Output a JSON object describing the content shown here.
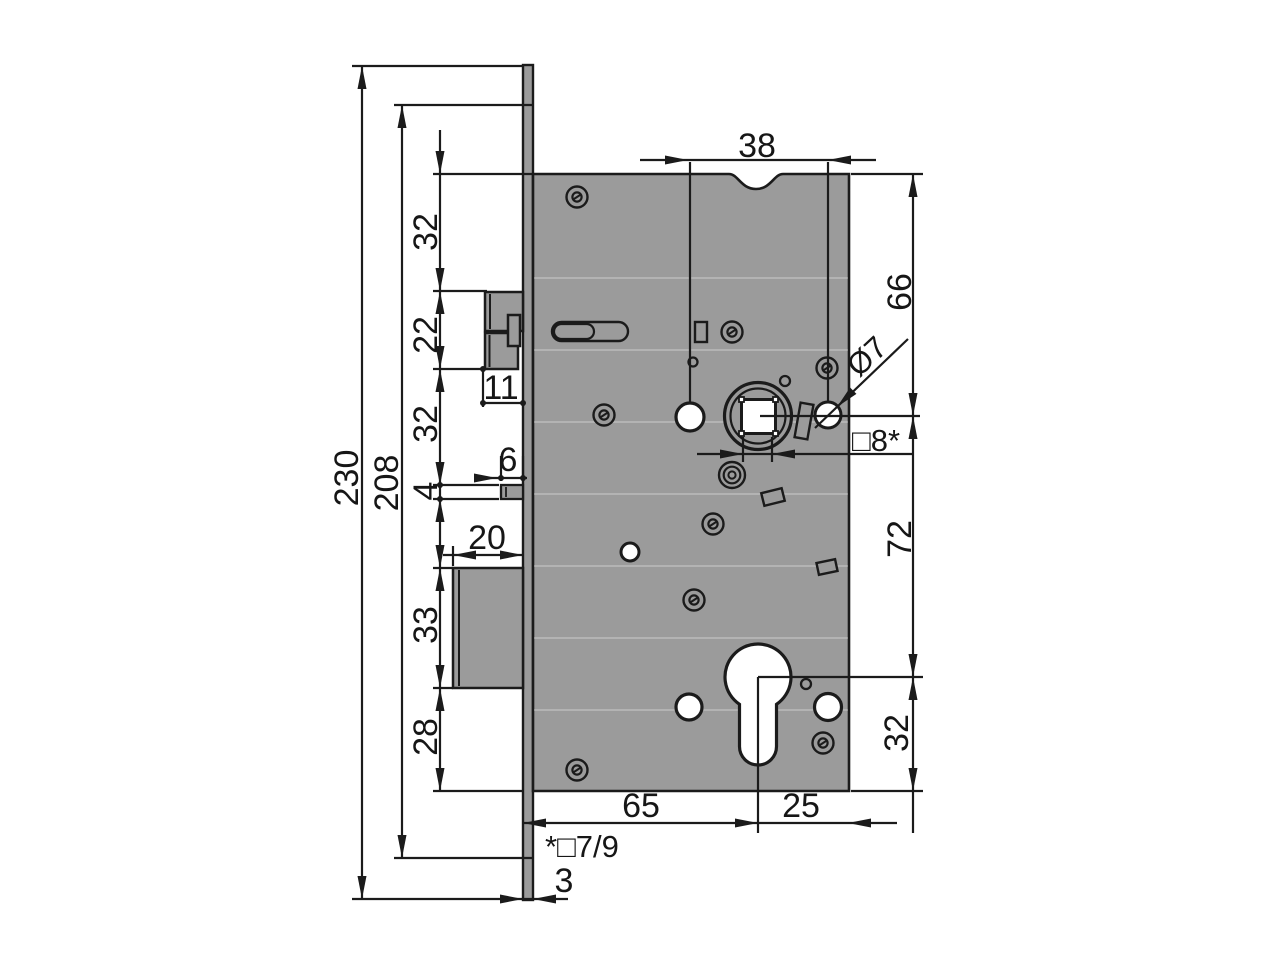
{
  "drawing": {
    "kind": "mortise-lock dimensional drawing",
    "colors": {
      "metal": "#9b9b9b",
      "line": "#1b1b1b",
      "background": "#ffffff"
    },
    "labels": {
      "total_height": "230",
      "plate_height": "208",
      "top_to_latch": "32",
      "latch_height": "22",
      "latch_to_pin": "32",
      "pin_height": "4",
      "latch_width": "11",
      "pin_width": "6",
      "bolt_width": "20",
      "bolt_height": "33",
      "bolt_to_bottom": "28",
      "hub_spacing": "38",
      "top_to_follower": "66",
      "follower_to_cylinder": "72",
      "cylinder_to_bottom": "32",
      "hole_diameter": "Ø7",
      "follower_square": "□8*",
      "backset": "65",
      "edge_distance": "25",
      "square_note": "*□7/9",
      "plate_thickness": "3"
    }
  }
}
